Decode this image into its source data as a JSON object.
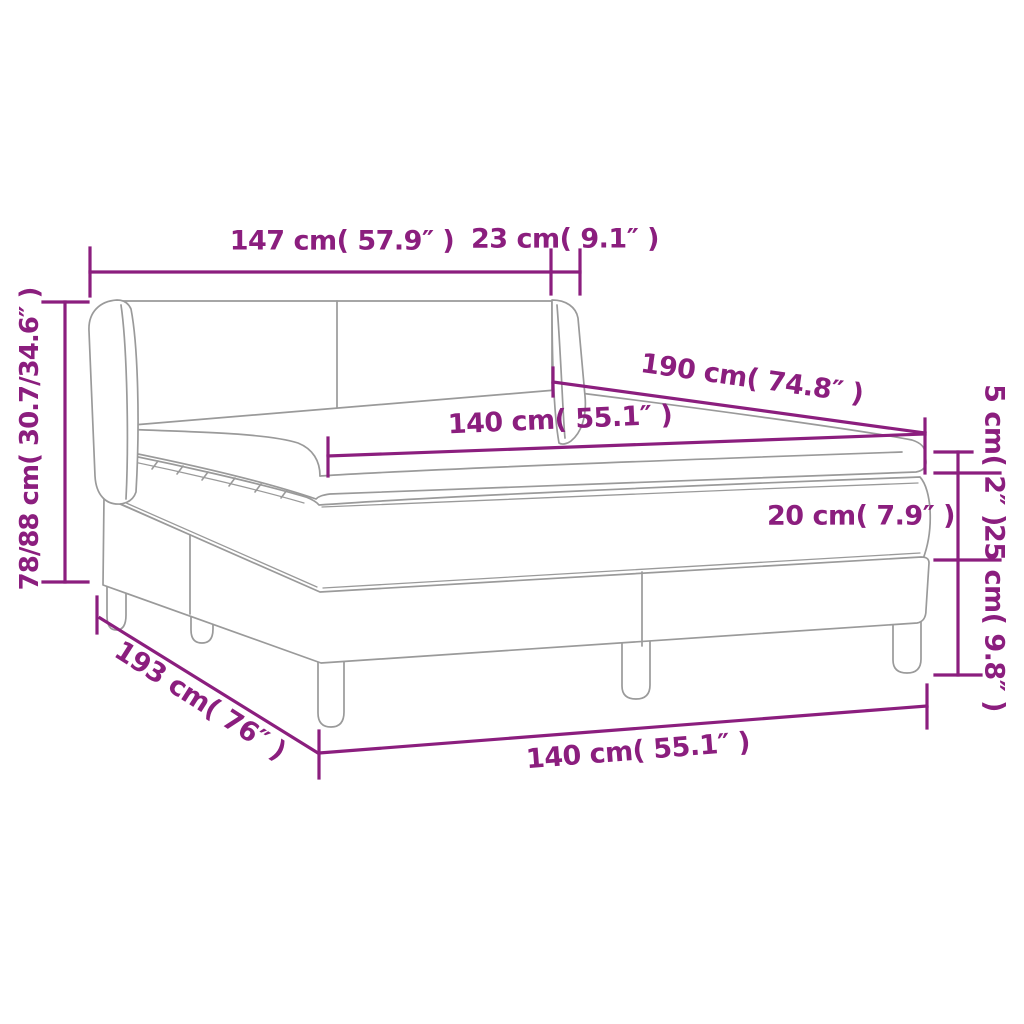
{
  "diagram": {
    "subject": "Box spring bed with headboard — dimension diagram",
    "colors": {
      "dimension_accent": "#8B1E7E",
      "outline_gray": "#9A9A9A",
      "background": "#FFFFFF"
    },
    "labels": {
      "headboard_width": "147 cm( 57.9″ )",
      "wing_depth": "23 cm( 9.1″ )",
      "bed_length_top": "190 cm( 74.8″ )",
      "mattress_width_top": "140 cm( 55.1″ )",
      "topper_height": "5 cm( 2″ )",
      "mattress_height": "20 cm( 7.9″ )",
      "base_height": "25 cm( 9.8″ )",
      "headboard_height": "78/88 cm( 30.7/34.6″ )",
      "bed_length_bottom": "193 cm( 76″ )",
      "bed_width_bottom": "140 cm( 55.1″ )"
    }
  }
}
